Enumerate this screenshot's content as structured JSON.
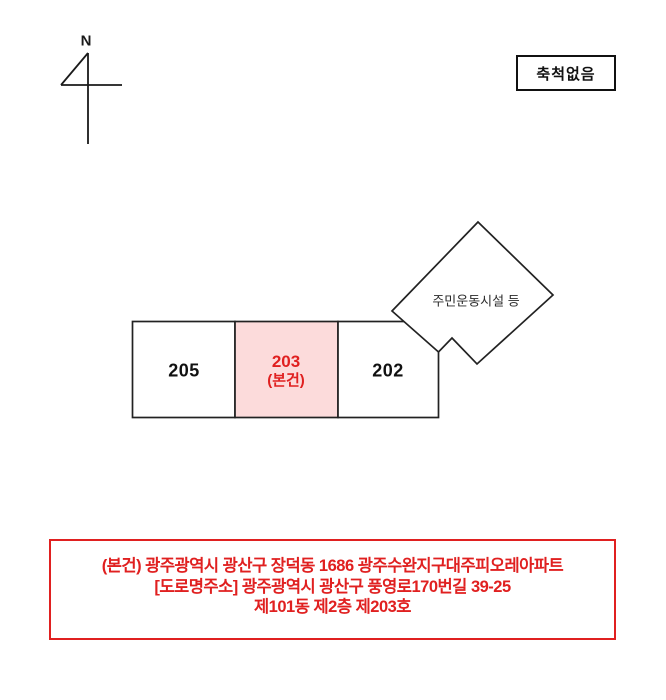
{
  "compass": {
    "label": "N"
  },
  "scale_box": {
    "label": "축척없음"
  },
  "site_plan": {
    "blocks": [
      {
        "id": "block-205",
        "label": "205",
        "highlight": false
      },
      {
        "id": "block-203",
        "label": "203",
        "sublabel": "(본건)",
        "highlight": true
      },
      {
        "id": "block-202",
        "label": "202",
        "highlight": false
      }
    ],
    "facility": {
      "label": "주민운동시설 등",
      "shape": "diamond"
    },
    "colors": {
      "line": "#222222",
      "highlight_fill": "#fcdbdb",
      "highlight_text": "#e02020",
      "label_text": "#111111"
    }
  },
  "address_box": {
    "lines": [
      "(본건) 광주광역시 광산구 장덕동 1686 광주수완지구대주피오레아파트",
      "[도로명주소] 광주광역시 광산구 풍영로170번길 39-25",
      "제101동 제2층 제203호"
    ],
    "colors": {
      "border": "#e02020",
      "text": "#e02020"
    }
  }
}
